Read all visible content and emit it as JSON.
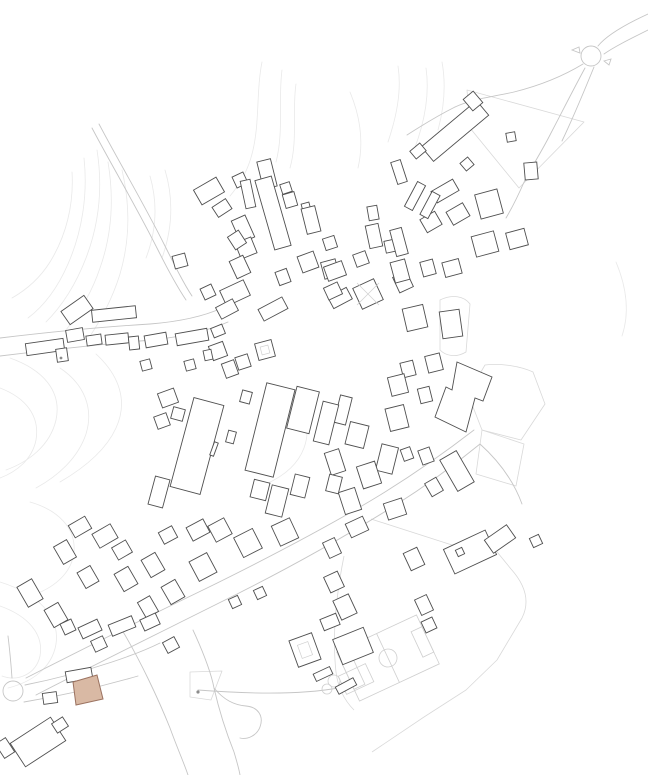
{
  "palette": {
    "background": "#ffffff",
    "building_stroke": "#4f4f4f",
    "building_fill": "#ffffff",
    "contour": "#e9e9e9",
    "road": "#c6c6c6",
    "parcel": "#d9d9d9",
    "field_line": "#cfcfcf",
    "site_fill": "#d9b9a4",
    "site_stroke": "#9b7260",
    "marker": "#8c8c8c"
  },
  "map": {
    "canvas": {
      "width": 648,
      "height": 775
    },
    "contours": [
      "M84,158 C88,195 82,232 68,264 C58,287 44,306 28,318",
      "M97,150 C103,188 99,224 86,258 C76,284 62,306 46,322",
      "M72,172 C74,205 66,236 50,262 C40,278 26,290 12,298",
      "M108,162 C114,198 112,234 100,268 C92,292 80,312 66,330",
      "M122,170 C130,204 130,240 120,274 C112,300 100,322 86,342",
      "M150,176 C158,204 156,232 146,258",
      "M165,170 C174,200 172,230 162,258",
      "M262,62 C256,92 260,124 252,154 C248,170 240,184 230,196",
      "M282,70 C278,100 284,132 276,162",
      "M296,84 C292,110 298,140 290,168",
      "M350,92 C360,116 364,142 358,168",
      "M388,142 C396,118 402,92 398,66",
      "M414,150 C424,124 430,96 426,68",
      "M438,130 C444,108 446,84 442,62",
      "M10,358 C44,370 62,392 56,420 C50,446 28,462 6,470",
      "M0,388 C26,398 40,416 36,440 C32,460 16,472 0,478",
      "M60,368 C84,384 94,408 86,434 C78,458 58,476 36,488",
      "M96,354 C120,376 128,402 116,428 C106,450 84,468 60,482",
      "M30,502 C58,510 76,528 74,552 C72,572 56,586 36,594",
      "M0,606 C28,616 44,634 40,656 C36,674 18,682 2,676",
      "M0,582 C38,594 60,616 56,644 C52,668 32,682 8,688",
      "M286,390 C304,406 312,426 304,448 C298,464 284,476 266,484",
      "M616,262 C626,286 630,312 622,336"
    ],
    "roads": [
      "M92,128 C112,166 136,206 158,250 C168,270 178,288 186,300",
      "M99,124 C119,162 143,202 165,246 C175,266 184,284 192,296",
      "M0,338 C50,332 100,327 150,324 C175,322 200,318 222,308",
      "M0,356 C50,350 102,344 152,340 C180,337 205,332 228,322",
      "M648,14 C622,26 606,36 598,46",
      "M648,30 C628,40 614,47 604,54",
      "M583,64 C560,78 538,86 514,92 C492,97 472,99 455,107",
      "M585,68 C572,92 562,112 551,133 C543,149 534,163 525,180",
      "M594,67 C583,94 573,118 562,141",
      "M455,107 C437,116 421,126 407,135",
      "M525,180 C518,196 512,208 506,218",
      "M26,678 C85,648 145,618 205,589 C268,558 330,526 385,492 C425,467 452,447 474,430",
      "M36,695 C96,664 157,634 217,604 C278,574 338,541 394,506 C432,482 458,462 480,444",
      "M122,630 C140,660 158,698 170,728 C178,750 184,763 188,775",
      "M193,630 C204,654 211,672 214,688 C219,710 226,732 234,752 C237,762 239,769 240,775",
      "M214,688 C224,700 234,705 246,706 C258,707 264,716 260,727 C257,735 248,740 240,738",
      "M198,690 C250,694 300,695 338,688",
      "M480,444 C500,462 514,482 522,504",
      "M8,636 C10,652 11,664 12,678",
      "M25,685 C55,679 85,671 112,662 C130,656 146,650 160,643",
      "M24,702 C60,696 100,687 138,676"
    ],
    "roundabouts": [
      {
        "cx": 591,
        "cy": 56,
        "r": 10
      },
      {
        "cx": 13,
        "cy": 691,
        "r": 10
      }
    ],
    "road_islands": [
      "M572,50 l7,-3 l1,6 z",
      "M604,61 l7,-2 l-2,6 z"
    ],
    "parcels": [
      "M467,90 L584,122 L519,188 L470,128 Z",
      "M485,365 C500,363 520,366 533,372 L545,404 L521,440 L482,430 L468,394 Z",
      "M482,430 L524,444 L516,486 L476,474 Z",
      "M371,519 L452,545 L484,536 L511,569 C528,588 529,604 522,618 L497,660 L466,690 L424,717 L372,752",
      "M344,556 C336,596 332,636 336,672 C338,688 344,700 354,710",
      "M190,672 L222,671 L211,700 L190,697 Z",
      "M440,300 C452,294 464,296 470,304 L466,352 C456,358 446,356 440,350 Z"
    ],
    "buildings": [
      [
        209,
        191,
        26,
        17,
        -30
      ],
      [
        222,
        208,
        16,
        12,
        -33
      ],
      [
        240,
        180,
        12,
        12,
        -25
      ],
      [
        267,
        174,
        14,
        28,
        -14
      ],
      [
        248,
        194,
        10,
        28,
        -12
      ],
      [
        273,
        213,
        17,
        72,
        -16
      ],
      [
        290,
        200,
        12,
        14,
        -16
      ],
      [
        306,
        207,
        8,
        8,
        -15
      ],
      [
        311,
        220,
        14,
        26,
        -14
      ],
      [
        286,
        188,
        10,
        10,
        -18
      ],
      [
        330,
        243,
        12,
        12,
        -18
      ],
      [
        243,
        229,
        15,
        24,
        -24
      ],
      [
        246,
        248,
        17,
        17,
        -22
      ],
      [
        240,
        267,
        15,
        19,
        -25
      ],
      [
        237,
        240,
        13,
        15,
        -33
      ],
      [
        235,
        293,
        26,
        17,
        -25
      ],
      [
        227,
        309,
        19,
        13,
        -28
      ],
      [
        208,
        292,
        12,
        12,
        -25
      ],
      [
        218,
        331,
        12,
        10,
        -22
      ],
      [
        273,
        309,
        27,
        13,
        -28
      ],
      [
        283,
        277,
        12,
        14,
        -20
      ],
      [
        308,
        262,
        17,
        17,
        -20
      ],
      [
        330,
        269,
        15,
        17,
        -15
      ],
      [
        361,
        259,
        13,
        13,
        -20
      ],
      [
        373,
        213,
        10,
        14,
        -10
      ],
      [
        374,
        236,
        13,
        23,
        -12
      ],
      [
        391,
        246,
        12,
        12,
        -12
      ],
      [
        403,
        282,
        15,
        17,
        -25
      ],
      [
        340,
        298,
        21,
        13,
        -28
      ],
      [
        180,
        261,
        13,
        13,
        -15
      ],
      [
        218,
        351,
        15,
        15,
        -20
      ],
      [
        230,
        369,
        13,
        15,
        -20
      ],
      [
        243,
        362,
        13,
        13,
        -18
      ],
      [
        265,
        350,
        17,
        17,
        -15
      ],
      [
        455,
        131,
        72,
        19,
        -40
      ],
      [
        473,
        101,
        13,
        15,
        -40
      ],
      [
        418,
        151,
        13,
        10,
        -40
      ],
      [
        399,
        172,
        10,
        23,
        -18
      ],
      [
        511,
        137,
        9,
        9,
        -10
      ],
      [
        531,
        171,
        13,
        17,
        -5
      ],
      [
        467,
        164,
        10,
        10,
        -40
      ],
      [
        445,
        191,
        25,
        13,
        -30
      ],
      [
        489,
        204,
        23,
        25,
        -15
      ],
      [
        458,
        214,
        19,
        15,
        -30
      ],
      [
        431,
        222,
        17,
        15,
        -30
      ],
      [
        415,
        196,
        9,
        28,
        28
      ],
      [
        430,
        205,
        9,
        26,
        28
      ],
      [
        399,
        242,
        12,
        27,
        -15
      ],
      [
        485,
        244,
        23,
        21,
        -15
      ],
      [
        517,
        239,
        19,
        17,
        -15
      ],
      [
        335,
        271,
        19,
        15,
        -20
      ],
      [
        333,
        291,
        15,
        13,
        -25
      ],
      [
        368,
        294,
        23,
        23,
        -25
      ],
      [
        400,
        271,
        15,
        21,
        -15
      ],
      [
        428,
        268,
        13,
        15,
        -15
      ],
      [
        452,
        268,
        17,
        15,
        -15
      ],
      [
        415,
        318,
        21,
        23,
        -13
      ],
      [
        451,
        324,
        20,
        27,
        -8
      ],
      [
        434,
        363,
        15,
        17,
        -14
      ],
      [
        408,
        369,
        13,
        15,
        -14
      ],
      [
        398,
        385,
        17,
        19,
        -14
      ],
      [
        425,
        395,
        12,
        15,
        -14
      ],
      [
        397,
        418,
        19,
        23,
        -14
      ],
      [
        457,
        471,
        19,
        36,
        -30
      ],
      [
        426,
        456,
        12,
        15,
        -20
      ],
      [
        407,
        454,
        10,
        12,
        -20
      ],
      [
        387,
        459,
        17,
        27,
        14
      ],
      [
        357,
        435,
        19,
        23,
        14
      ],
      [
        343,
        410,
        12,
        28,
        14
      ],
      [
        369,
        475,
        19,
        23,
        -18
      ],
      [
        335,
        462,
        15,
        23,
        -18
      ],
      [
        350,
        501,
        17,
        23,
        -18
      ],
      [
        395,
        509,
        19,
        17,
        -18
      ],
      [
        434,
        487,
        13,
        15,
        -30
      ],
      [
        197,
        446,
        31,
        92,
        15
      ],
      [
        178,
        414,
        12,
        12,
        15
      ],
      [
        231,
        437,
        8,
        12,
        15
      ],
      [
        214,
        449,
        4,
        14,
        20
      ],
      [
        270,
        430,
        29,
        90,
        14
      ],
      [
        246,
        397,
        10,
        12,
        15
      ],
      [
        303,
        410,
        23,
        43,
        14
      ],
      [
        326,
        423,
        16,
        41,
        14
      ],
      [
        260,
        490,
        16,
        18,
        14
      ],
      [
        277,
        501,
        17,
        29,
        14
      ],
      [
        300,
        486,
        15,
        21,
        14
      ],
      [
        334,
        484,
        13,
        17,
        14
      ],
      [
        159,
        492,
        15,
        29,
        15
      ],
      [
        198,
        530,
        19,
        15,
        -28
      ],
      [
        168,
        535,
        15,
        13,
        -28
      ],
      [
        168,
        398,
        17,
        15,
        -20
      ],
      [
        162,
        421,
        13,
        13,
        -20
      ],
      [
        77,
        310,
        28,
        16,
        -35
      ],
      [
        114,
        314,
        44,
        12,
        -6
      ],
      [
        45,
        347,
        38,
        12,
        -8
      ],
      [
        75,
        335,
        17,
        12,
        -10
      ],
      [
        94,
        340,
        15,
        10,
        -8
      ],
      [
        117,
        339,
        23,
        10,
        -6
      ],
      [
        134,
        343,
        10,
        13,
        -6
      ],
      [
        62,
        355,
        11,
        13,
        -8
      ],
      [
        156,
        340,
        22,
        12,
        -10
      ],
      [
        192,
        337,
        32,
        12,
        -10
      ],
      [
        208,
        355,
        8,
        10,
        -12
      ],
      [
        190,
        365,
        10,
        10,
        -15
      ],
      [
        146,
        365,
        10,
        10,
        -15
      ],
      [
        80,
        527,
        19,
        14,
        -30
      ],
      [
        105,
        536,
        21,
        16,
        -30
      ],
      [
        122,
        550,
        16,
        14,
        -30
      ],
      [
        65,
        552,
        15,
        20,
        -30
      ],
      [
        88,
        577,
        15,
        18,
        -30
      ],
      [
        30,
        593,
        17,
        23,
        -30
      ],
      [
        56,
        615,
        16,
        20,
        -30
      ],
      [
        126,
        579,
        16,
        20,
        -30
      ],
      [
        153,
        565,
        16,
        20,
        -30
      ],
      [
        148,
        607,
        14,
        18,
        -30
      ],
      [
        173,
        592,
        16,
        20,
        -30
      ],
      [
        203,
        567,
        20,
        22,
        -28
      ],
      [
        220,
        530,
        18,
        18,
        -28
      ],
      [
        248,
        543,
        21,
        22,
        -27
      ],
      [
        285,
        532,
        20,
        22,
        -25
      ],
      [
        235,
        602,
        10,
        10,
        -25
      ],
      [
        260,
        593,
        10,
        10,
        -25
      ],
      [
        68,
        627,
        12,
        12,
        -25
      ],
      [
        90,
        629,
        21,
        12,
        -25
      ],
      [
        122,
        626,
        25,
        12,
        -22
      ],
      [
        150,
        622,
        17,
        12,
        -25
      ],
      [
        99,
        644,
        13,
        12,
        -25
      ],
      [
        171,
        645,
        13,
        12,
        -28
      ],
      [
        50,
        698,
        14,
        11,
        -8
      ],
      [
        79,
        675,
        26,
        11,
        -10
      ],
      [
        38,
        742,
        48,
        28,
        -33
      ],
      [
        60,
        725,
        13,
        11,
        -33
      ],
      [
        5,
        748,
        12,
        17,
        -33
      ],
      [
        334,
        582,
        15,
        17,
        -25
      ],
      [
        345,
        607,
        17,
        21,
        -25
      ],
      [
        332,
        548,
        13,
        17,
        -25
      ],
      [
        357,
        527,
        19,
        15,
        -25
      ],
      [
        470,
        552,
        46,
        27,
        -25
      ],
      [
        500,
        539,
        27,
        16,
        -35
      ],
      [
        536,
        541,
        10,
        10,
        -25
      ],
      [
        460,
        552,
        7,
        7,
        -25
      ],
      [
        414,
        559,
        15,
        19,
        -25
      ],
      [
        424,
        605,
        13,
        17,
        -25
      ],
      [
        429,
        625,
        12,
        12,
        -25
      ],
      [
        305,
        650,
        24,
        28,
        -20
      ],
      [
        323,
        674,
        18,
        8,
        -25
      ],
      [
        353,
        646,
        33,
        27,
        -22
      ],
      [
        330,
        622,
        17,
        12,
        -22
      ],
      [
        346,
        686,
        20,
        8,
        -28
      ]
    ],
    "building_polygons": [
      "457,362 492,377 483,401 475,398 466,432 435,417 446,387 452,390"
    ],
    "courtyards": [
      [
        265,
        350,
        8,
        8,
        -15
      ],
      [
        305,
        650,
        11,
        14,
        -20
      ]
    ],
    "roof_lines": [
      "M357,283 L379,305",
      "M379,283 L357,305"
    ],
    "field_shapes": [
      {
        "t": "rect",
        "x": -44,
        "y": -27,
        "w": 88,
        "h": 54,
        "tf": "translate(388,658) rotate(-25)"
      },
      {
        "t": "line",
        "x1": 0,
        "y1": -27,
        "x2": 0,
        "y2": 27,
        "tf": "translate(388,658) rotate(-25)"
      },
      {
        "t": "circle",
        "cx": 0,
        "cy": 0,
        "r": 9,
        "tf": "translate(388,658) rotate(-25)"
      },
      {
        "t": "rect",
        "x": -44,
        "y": -14,
        "w": 12,
        "h": 28,
        "tf": "translate(388,658) rotate(-25)"
      },
      {
        "t": "rect",
        "x": 32,
        "y": -14,
        "w": 12,
        "h": 28,
        "tf": "translate(388,658) rotate(-25)"
      },
      {
        "t": "rect",
        "x": -15,
        "y": -10,
        "w": 30,
        "h": 20,
        "tf": "translate(356,679) rotate(-25)"
      },
      {
        "t": "circle",
        "cx": 334,
        "cy": 681,
        "r": 6
      },
      {
        "t": "circle",
        "cx": 327,
        "cy": 689,
        "r": 5
      }
    ],
    "site_building": {
      "points": "73,682 97,675 103,699 76,705"
    },
    "markers": [
      {
        "cx": 198,
        "cy": 692,
        "r": 1.6
      },
      {
        "cx": 61,
        "cy": 358,
        "r": 1.4
      }
    ]
  }
}
